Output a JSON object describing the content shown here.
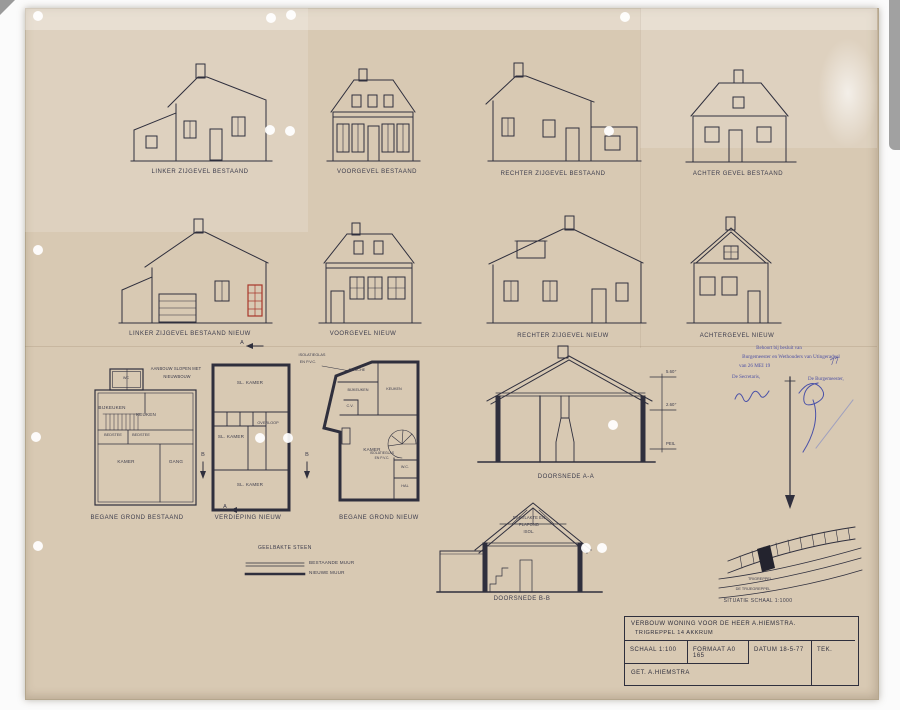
{
  "sheet": {
    "elevations_existing": [
      {
        "label": "LINKER ZIJGEVEL BESTAAND"
      },
      {
        "label": "VOORGEVEL BESTAAND"
      },
      {
        "label": "RECHTER ZIJGEVEL BESTAAND"
      },
      {
        "label": "ACHTER GEVEL BESTAAND"
      }
    ],
    "elevations_new": [
      {
        "label": "LINKER ZIJGEVEL BESTAAND NIEUW"
      },
      {
        "label": "VOORGEVEL NIEUW"
      },
      {
        "label": "RECHTER ZIJGEVEL NIEUW"
      },
      {
        "label": "ACHTERGEVEL NIEUW"
      }
    ],
    "plans": {
      "bestaand": {
        "caption": "BEGANE GROND BESTAAND",
        "rooms": [
          "WC",
          "BIJKEUKEN",
          "KEUKEN",
          "BEDSTEE",
          "BEDSTEE",
          "KAMER",
          "GANG"
        ],
        "note_line1": "AANBOUW SLOPEN MET",
        "note_line2": "NIEUWBOUW"
      },
      "verdieping": {
        "caption": "VERDIEPING NIEUW",
        "rooms": [
          "SL. KAMER",
          "SL. KAMER",
          "OVERLOOP",
          "SL. KAMER"
        ]
      },
      "nieuw": {
        "caption": "BEGANE GROND NIEUW",
        "rooms": [
          "DOUCHE",
          "BIJKEUKEN",
          "KEUKEN",
          "C.V.",
          "KAMER",
          "W.C.",
          "HAL"
        ],
        "note_line1": "ISOLATIEGLAS",
        "note_line2": "EN P.V.C."
      }
    },
    "sections": {
      "aa": {
        "caption": "DOORSNEDE A-A",
        "levels": [
          "5.60⁺",
          "2.60⁺",
          "PEIL"
        ]
      },
      "bb": {
        "caption": "DOORSNEDE B-B",
        "note": [
          "DAKVLAKTE EN",
          "PLAFOND",
          "ISOL."
        ]
      }
    },
    "markers": {
      "a": "A",
      "b": "B"
    },
    "legend": {
      "heading": "GEELBAKTE STEEN",
      "existing": "BESTAANDE MUUR",
      "new": "NIEUWE MUUR"
    },
    "situatie": {
      "road1": "TRIGREPPEL",
      "road2": "DE TRIJEGREPPEL",
      "caption": "SITUATIE SCHAAL 1:1000"
    },
    "stamp": {
      "line1": "Behoort bij besluit van",
      "line2": "Burgemeester en Wethouders van Utingeradeel",
      "line3": "van 26 MEI 19",
      "year": "77",
      "secretaris": "De Secretaris,",
      "burgemeester": "De Burgemeester,"
    },
    "titleblock": {
      "title_line1": "VERBOUW  WONING  VOOR DE HEER   A.HIEMSTRA.",
      "title_line2": "TRIGREPPEL 14    AKKRUM",
      "schaal": "SCHAAL  1:100",
      "formaat": "FORMAAT  A0 165",
      "datum": "DATUM 18-5-77",
      "tek": "TEK.",
      "getekend": "GET. A.HIEMSTRA"
    }
  },
  "colors": {
    "paper": "#d8c9b3",
    "ink": "#2f2f3d",
    "stamp_blue": "#4d50a4",
    "accent_red": "#a8372b"
  }
}
